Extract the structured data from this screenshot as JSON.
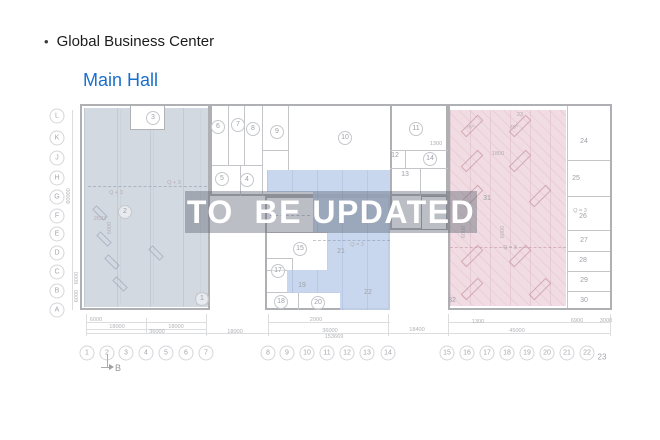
{
  "header": {
    "bullet": "•",
    "title": "Global Business Center",
    "subtitle": "Main Hall"
  },
  "watermark": {
    "text": "TO  BE UPDATED"
  },
  "plan": {
    "section_marker": {
      "label": "B"
    },
    "colors": {
      "left_zone_fill": "#cdd4dd",
      "middle_zone_fill": "#c1d2ec",
      "right_zone_fill": "#eed6de",
      "subtitle_accent": "#1a6fcc",
      "watermark_text": "#ffffff"
    },
    "row_labels": [
      {
        "label": "L",
        "y": 116
      },
      {
        "label": "K",
        "y": 138
      },
      {
        "label": "J",
        "y": 158
      },
      {
        "label": "H",
        "y": 178
      },
      {
        "label": "G",
        "y": 197
      },
      {
        "label": "F",
        "y": 216
      },
      {
        "label": "E",
        "y": 234
      },
      {
        "label": "D",
        "y": 253
      },
      {
        "label": "C",
        "y": 272
      },
      {
        "label": "B",
        "y": 291
      },
      {
        "label": "A",
        "y": 310
      }
    ],
    "col_labels": [
      {
        "label": "1",
        "x": 87
      },
      {
        "label": "2",
        "x": 107
      },
      {
        "label": "3",
        "x": 126
      },
      {
        "label": "4",
        "x": 146
      },
      {
        "label": "5",
        "x": 166
      },
      {
        "label": "6",
        "x": 186
      },
      {
        "label": "7",
        "x": 206
      },
      {
        "label": "8",
        "x": 268
      },
      {
        "label": "9",
        "x": 287
      },
      {
        "label": "10",
        "x": 307
      },
      {
        "label": "11",
        "x": 327
      },
      {
        "label": "12",
        "x": 347
      },
      {
        "label": "13",
        "x": 367
      },
      {
        "label": "14",
        "x": 388
      },
      {
        "label": "15",
        "x": 447
      },
      {
        "label": "16",
        "x": 467
      },
      {
        "label": "17",
        "x": 487
      },
      {
        "label": "18",
        "x": 507
      },
      {
        "label": "19",
        "x": 527
      },
      {
        "label": "20",
        "x": 547
      },
      {
        "label": "21",
        "x": 567
      },
      {
        "label": "22",
        "x": 587
      },
      {
        "label": "23",
        "x": 602,
        "y": 357,
        "circle": false
      }
    ],
    "rooms": [
      {
        "num": "1",
        "x": 202,
        "y": 299,
        "circle": true
      },
      {
        "num": "2",
        "x": 125,
        "y": 212,
        "circle": true
      },
      {
        "num": "3",
        "x": 153,
        "y": 118,
        "circle": true
      },
      {
        "num": "4",
        "x": 247,
        "y": 180,
        "circle": true
      },
      {
        "num": "5",
        "x": 222,
        "y": 179,
        "circle": true
      },
      {
        "num": "6",
        "x": 218,
        "y": 127,
        "circle": true
      },
      {
        "num": "7",
        "x": 238,
        "y": 125,
        "circle": true
      },
      {
        "num": "8",
        "x": 253,
        "y": 129,
        "circle": true
      },
      {
        "num": "9",
        "x": 277,
        "y": 132,
        "circle": true
      },
      {
        "num": "10",
        "x": 345,
        "y": 138,
        "circle": true
      },
      {
        "num": "11",
        "x": 416,
        "y": 129,
        "circle": true
      },
      {
        "num": "12",
        "x": 395,
        "y": 156,
        "circle": false
      },
      {
        "num": "13",
        "x": 405,
        "y": 175,
        "circle": false
      },
      {
        "num": "14",
        "x": 430,
        "y": 159,
        "circle": true
      },
      {
        "num": "15",
        "x": 300,
        "y": 249,
        "circle": true
      },
      {
        "num": "17",
        "x": 278,
        "y": 271,
        "circle": true
      },
      {
        "num": "18",
        "x": 281,
        "y": 302,
        "circle": true
      },
      {
        "num": "19",
        "x": 302,
        "y": 286,
        "circle": false
      },
      {
        "num": "20",
        "x": 318,
        "y": 303,
        "circle": true
      },
      {
        "num": "21",
        "x": 341,
        "y": 252,
        "circle": false
      },
      {
        "num": "22",
        "x": 368,
        "y": 293,
        "circle": false
      },
      {
        "num": "24",
        "x": 584,
        "y": 142,
        "circle": false
      },
      {
        "num": "25",
        "x": 576,
        "y": 179,
        "circle": false
      },
      {
        "num": "26",
        "x": 583,
        "y": 217,
        "circle": false
      },
      {
        "num": "27",
        "x": 584,
        "y": 241,
        "circle": false
      },
      {
        "num": "28",
        "x": 583,
        "y": 261,
        "circle": false
      },
      {
        "num": "29",
        "x": 584,
        "y": 281,
        "circle": false
      },
      {
        "num": "30",
        "x": 584,
        "y": 301,
        "circle": false
      },
      {
        "num": "31",
        "x": 487,
        "y": 199,
        "circle": false
      },
      {
        "num": "32",
        "x": 452,
        "y": 301,
        "circle": false
      }
    ],
    "dimensions": [
      {
        "text": "6000",
        "x": 96,
        "y": 319
      },
      {
        "text": "2000",
        "x": 316,
        "y": 319
      },
      {
        "text": "1300",
        "x": 478,
        "y": 321
      },
      {
        "text": "6900",
        "x": 577,
        "y": 320
      },
      {
        "text": "3000",
        "x": 606,
        "y": 320
      },
      {
        "text": "18000",
        "x": 117,
        "y": 326
      },
      {
        "text": "18000",
        "x": 176,
        "y": 326
      },
      {
        "text": "36000",
        "x": 157,
        "y": 331
      },
      {
        "text": "18000",
        "x": 235,
        "y": 331
      },
      {
        "text": "36000",
        "x": 330,
        "y": 330
      },
      {
        "text": "18400",
        "x": 417,
        "y": 329
      },
      {
        "text": "45000",
        "x": 517,
        "y": 330
      },
      {
        "text": "153669",
        "x": 334,
        "y": 336
      }
    ],
    "vertical_dimensions": [
      {
        "text": "60000",
        "x": 68,
        "y": 196
      },
      {
        "text": "6000",
        "x": 76,
        "y": 278
      },
      {
        "text": "6000",
        "x": 76,
        "y": 296
      },
      {
        "text": "6000",
        "x": 109,
        "y": 228
      },
      {
        "text": "6000",
        "x": 463,
        "y": 232
      },
      {
        "text": "6000",
        "x": 502,
        "y": 232
      }
    ],
    "annotations": [
      {
        "text": "Q + 3",
        "x": 174,
        "y": 182
      },
      {
        "text": "Q + 3",
        "x": 116,
        "y": 192
      },
      {
        "text": "2693",
        "x": 100,
        "y": 218
      },
      {
        "text": "Q = 3",
        "x": 357,
        "y": 244
      },
      {
        "text": "Q = 3",
        "x": 580,
        "y": 210
      },
      {
        "text": "Q = 3",
        "x": 510,
        "y": 247
      },
      {
        "text": "23",
        "x": 520,
        "y": 114
      },
      {
        "text": "1800",
        "x": 498,
        "y": 153
      },
      {
        "text": "1300",
        "x": 436,
        "y": 143
      },
      {
        "text": "45°",
        "x": 470,
        "y": 127
      },
      {
        "text": "45°",
        "x": 514,
        "y": 127
      }
    ]
  }
}
